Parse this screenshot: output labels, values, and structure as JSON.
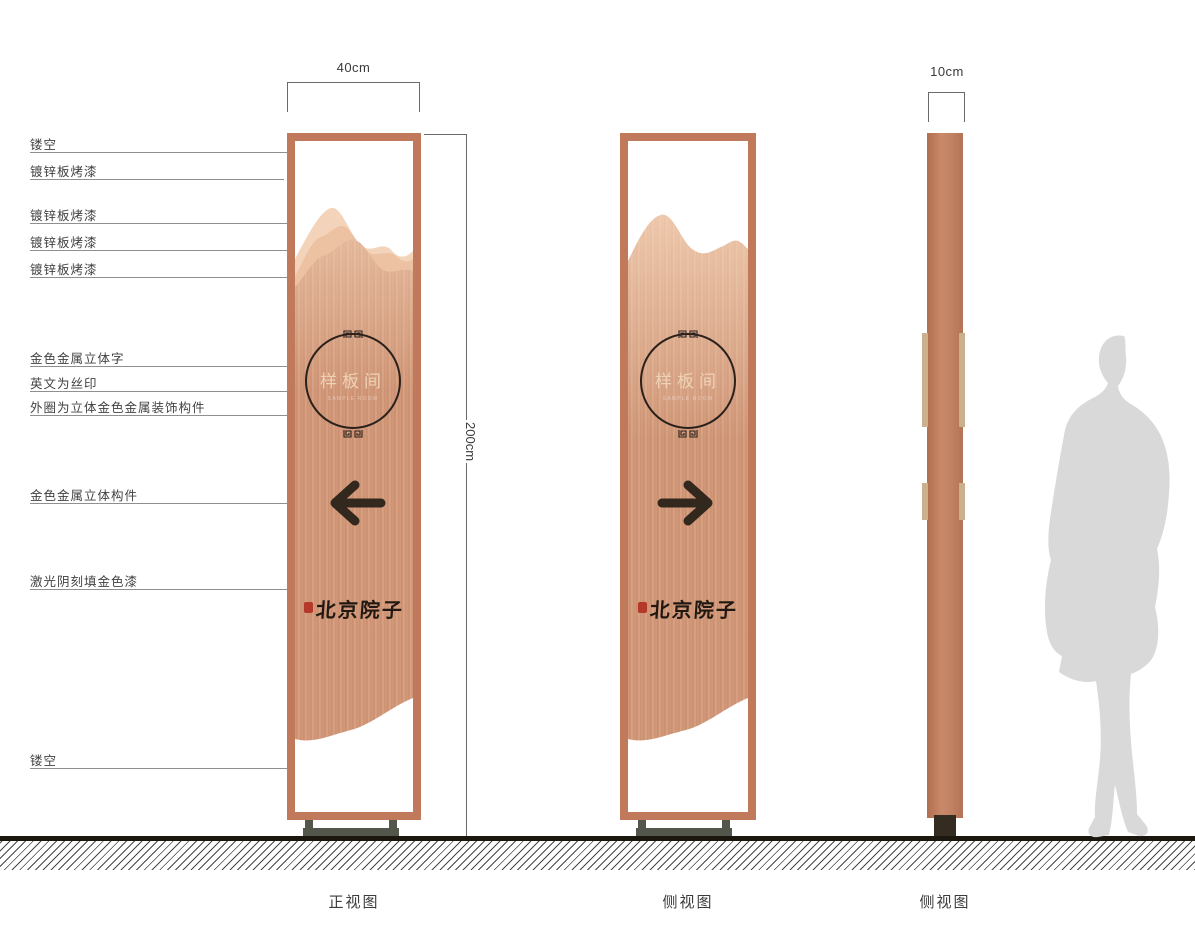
{
  "drawing": {
    "dimensions": {
      "front_width": "40cm",
      "side_thickness": "10cm",
      "height": "200cm"
    },
    "callouts": [
      {
        "label": "镂空"
      },
      {
        "label": "镀锌板烤漆"
      },
      {
        "label": "镀锌板烤漆"
      },
      {
        "label": "镀锌板烤漆"
      },
      {
        "label": "镀锌板烤漆"
      },
      {
        "label": "金色金属立体字"
      },
      {
        "label": "英文为丝印"
      },
      {
        "label": "外圈为立体金色金属装饰构件"
      },
      {
        "label": "金色金属立体构件"
      },
      {
        "label": "激光阴刻填金色漆"
      },
      {
        "label": "镂空"
      }
    ],
    "views": [
      {
        "label": "正视图"
      },
      {
        "label": "侧视图"
      },
      {
        "label": "侧视图"
      }
    ],
    "sign": {
      "room_name": "样板间",
      "room_name_en": "SAMPLE ROOM",
      "brand_name": "北京院子"
    },
    "colors": {
      "frame": "#c0795b",
      "panel_brush_light": "#dba688",
      "panel_brush_dark": "#c88d6e",
      "mountain_back": "#f3d3b9",
      "mountain_mid": "#ecc2a3",
      "metal_tab": "#cbb08e",
      "stand": "#53564a",
      "seal_red": "#b5392a",
      "arrow": "#32281e",
      "silhouette": "#d9d9d9"
    }
  }
}
